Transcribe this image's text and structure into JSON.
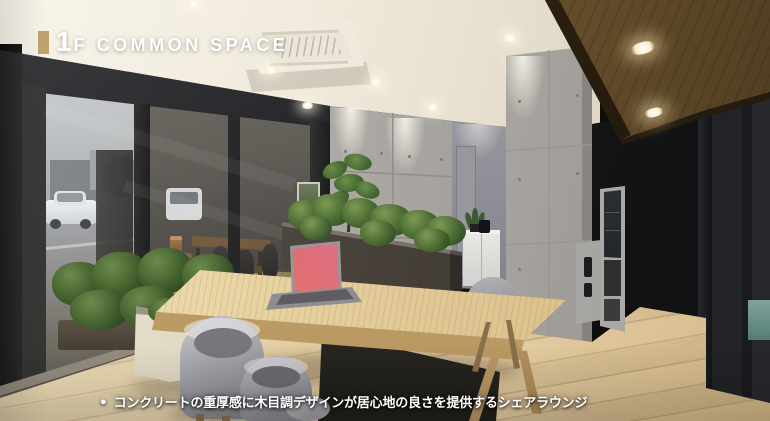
{
  "title": {
    "full": "1F COMMON SPACE",
    "number": "1",
    "label": "F COMMON SPACE"
  },
  "caption": {
    "bullet": "●",
    "text": "コンクリートの重厚感に木目調デザインが居心地の良さを提供するシェアラウンジ"
  },
  "palette": {
    "accent_gold": "#bfa16b",
    "text_white": "#ffffff",
    "ceiling_cream": "#efe8da",
    "concrete_gray": "#aca9a4",
    "wood_ceiling_brown": "#6b522d",
    "wood_floor_oak": "#dcc294",
    "planter_charcoal": "#45403a",
    "planter_cream": "#ddd6c4",
    "chair_gray": "#9a9ba0",
    "accent_wall_black": "#17181a"
  },
  "scene": {
    "description_icons": [
      "downlight-icon",
      "ac-cassette-icon",
      "laptop-icon",
      "plant-icon"
    ]
  }
}
